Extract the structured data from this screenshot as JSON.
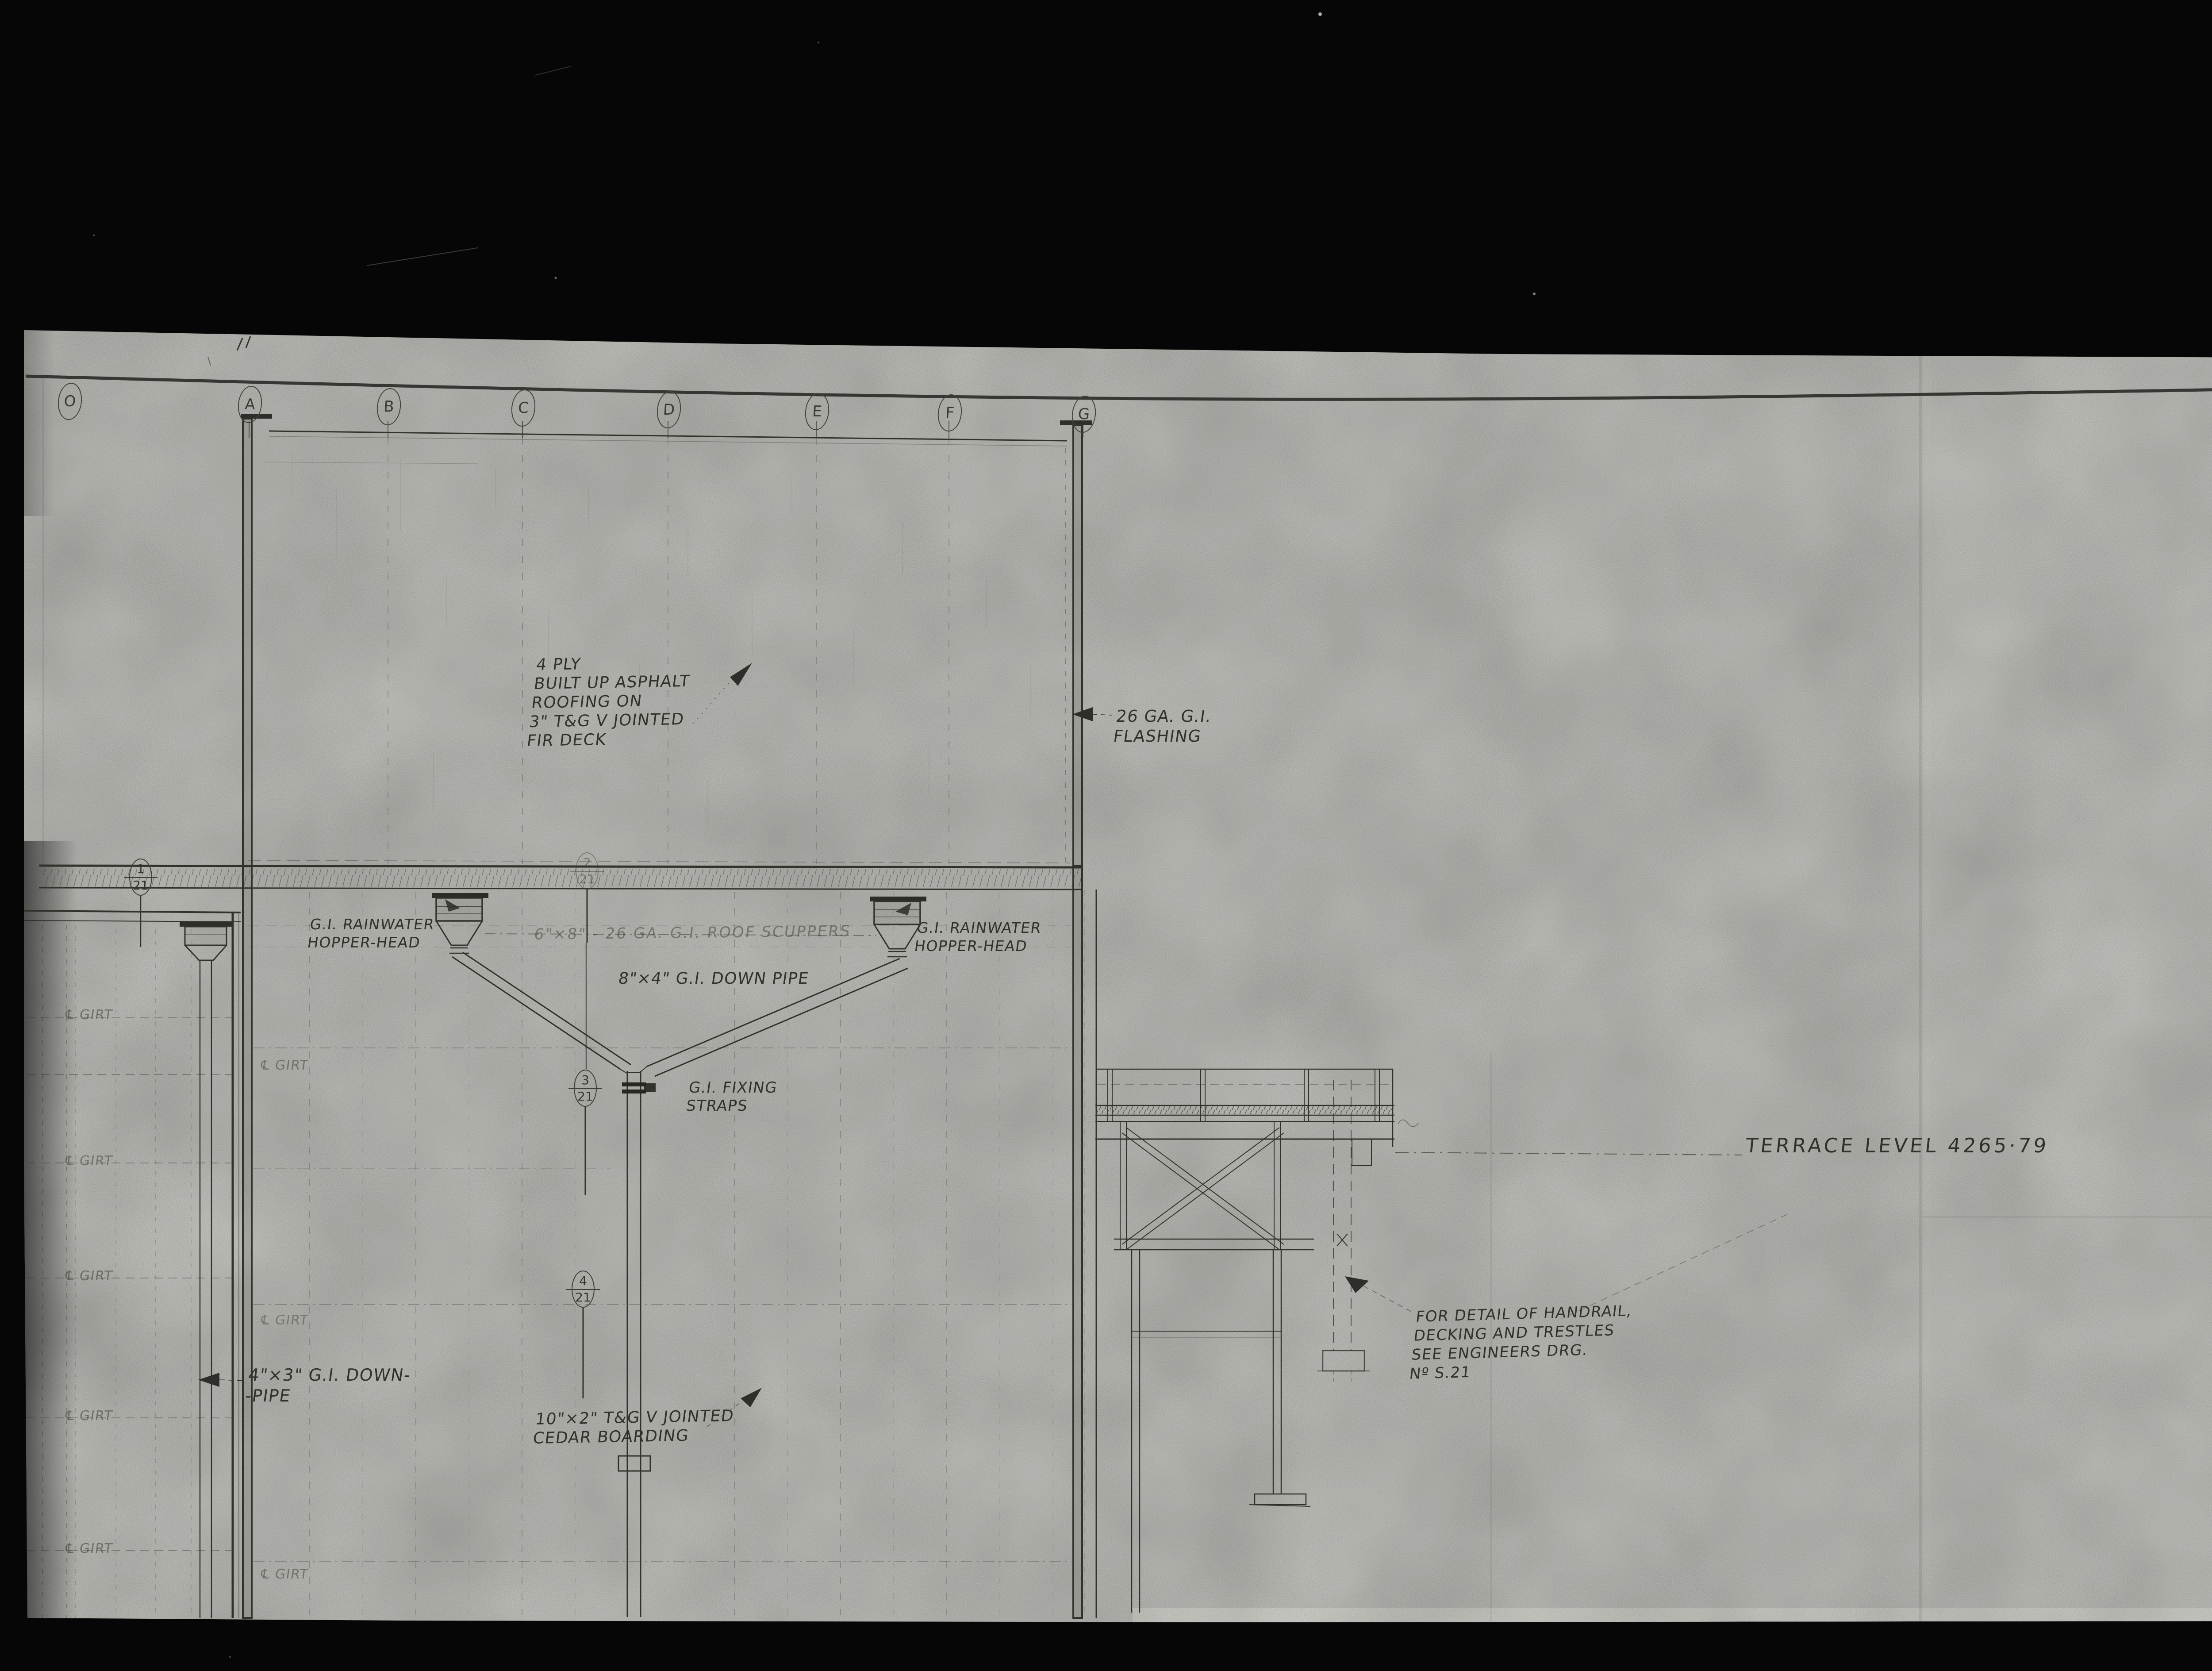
{
  "sheet": {
    "grid_letters": [
      "O",
      "A",
      "B",
      "C",
      "D",
      "E",
      "F",
      "G"
    ],
    "markers": [
      {
        "num": "1",
        "den": "21"
      },
      {
        "num": "2",
        "den": "21"
      },
      {
        "num": "3",
        "den": "21"
      },
      {
        "num": "4",
        "den": "21"
      }
    ],
    "annotations": {
      "roofing": [
        "4 PLY",
        "BUILT UP ASPHALT",
        "ROOFING ON",
        "3\" T&G V JOINTED",
        "FIR DECK"
      ],
      "flashing": [
        "26 GA. G.I.",
        "FLASHING"
      ],
      "rainwater_hopper": [
        "G.I. RAINWATER",
        "HOPPER-HEAD"
      ],
      "scuppers": "6\"×8\" - 26 GA. G.I. ROOF SCUPPERS",
      "down_pipe_8x4": "8\"×4\" G.I. DOWN PIPE",
      "fixing_straps": [
        "G.I. FIXING",
        "STRAPS"
      ],
      "terrace_level": "TERRACE LEVEL 4265·79",
      "handrail_note": [
        "FOR DETAIL OF HANDRAIL,",
        "DECKING AND TRESTLES",
        "SEE ENGINEERS DRG.",
        "Nº S.21"
      ],
      "down_pipe_4x3": [
        "4\"×3\" G.I. DOWN-",
        "-PIPE"
      ],
      "cedar_boarding": [
        "10\"×2\" T&G V JOINTED",
        "CEDAR BOARDING"
      ],
      "girt": "℄ GIRT"
    },
    "stamp_label": "2 of/de"
  }
}
